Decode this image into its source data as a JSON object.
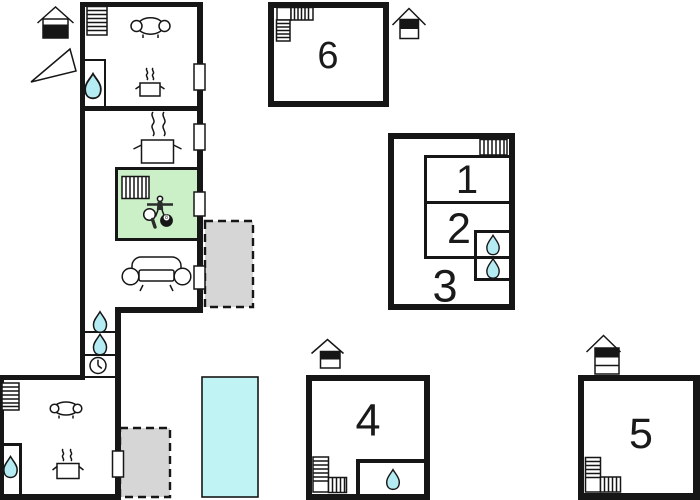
{
  "colors": {
    "wall": "#161616",
    "water": "#b5ecf3",
    "pool": "#c0f3f3",
    "green": "#cbefc6",
    "terrace": "#d6d6d6",
    "paper": "#ffffff"
  },
  "rooms": {
    "r1": {
      "label": "1"
    },
    "r2": {
      "label": "2"
    },
    "r3": {
      "label": "3"
    },
    "r4": {
      "label": "4"
    },
    "r5": {
      "label": "5"
    },
    "r6": {
      "label": "6"
    }
  },
  "billiard_ball": {
    "label": "8"
  },
  "icons": {
    "water-drop-icon": "teardrop",
    "radiator-icon": "striped rectangle",
    "stairs-icon": "striped steps",
    "sofa-icon": "sofa outline",
    "stove-icon": "pot with steam",
    "clock-icon": "clock face",
    "house-icon": "gabled house marker",
    "north-arrow-icon": "triangle",
    "table-tennis-icon": "paddle",
    "foosball-icon": "table-football figure",
    "billiard-ball-icon": "8-ball",
    "pool": "cyan rectangle",
    "terrace": "gray dashed rectangle"
  }
}
